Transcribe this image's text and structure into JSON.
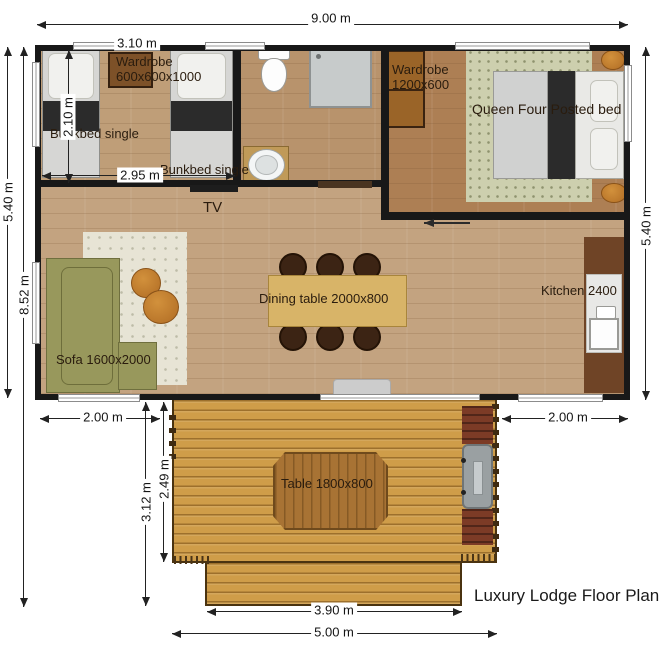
{
  "title": "Luxury Lodge Floor Plan",
  "labels": {
    "wardrobe_small": {
      "line1": "Wardrobe",
      "line2": "600x600x1000"
    },
    "bunkbed_1": "Bunkbed single",
    "bunkbed_2": "Bunkbed single",
    "wardrobe_master": {
      "line1": "Wardrobe",
      "line2": "1200x600"
    },
    "queen_bed": "Queen Four Posted bed",
    "tv": "TV",
    "dining_table": "Dining table 2000x800",
    "kitchen": "Kitchen 2400",
    "sofa": "Sofa 1600x2000",
    "deck_table": "Table 1800x800"
  },
  "dimensions": {
    "building_width": "9.00 m",
    "bedroom_width": "3.10 m",
    "bedroom_depth": "2.10 m",
    "bedroom_inner_width": "2.95 m",
    "building_depth_left": "5.40 m",
    "total_depth": "8.52 m",
    "building_depth_right": "5.40 m",
    "deck_offset_left": "2.00 m",
    "deck_offset_right": "2.00 m",
    "deck_total_depth": "3.12 m",
    "deck_upper_depth": "2.49 m",
    "deck_lower_width": "3.90 m",
    "deck_upper_width": "5.00 m"
  },
  "colors": {
    "wall": "#181818",
    "floor_living": "#c3a380",
    "floor_bedroom": "#bf9e78",
    "floor_bathroom": "#b8936c",
    "floor_master": "#ad7f54",
    "deck_wood": "#cf9d49",
    "sofa_green": "#98985c",
    "dining_table": "#d8b468",
    "planter": "#7c3b26"
  }
}
